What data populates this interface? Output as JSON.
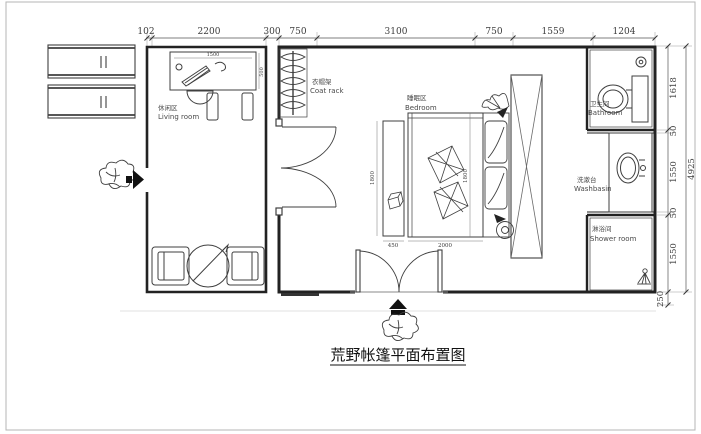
{
  "title": "荒野帐篷平面布置图",
  "labels": {
    "living": {
      "zh": "休闲区",
      "en": "Living room"
    },
    "coat_rack": {
      "zh": "衣帽架",
      "en": "Coat rack"
    },
    "bedroom": {
      "zh": "睡眠区",
      "en": "Bedroom"
    },
    "bathroom": {
      "zh": "卫生间",
      "en": "Bathroom"
    },
    "washbasin": {
      "zh": "洗漱台",
      "en": "Washbasin"
    },
    "shower": {
      "zh": "淋浴间",
      "en": "Shower room"
    }
  },
  "dimensions": {
    "top": [
      "102",
      "2200",
      "300",
      "750",
      "3100",
      "750",
      "1559",
      "1204"
    ],
    "right": [
      "1618",
      "50",
      "1550",
      "50",
      "1550",
      "250"
    ],
    "right_total": "4925",
    "bed_length": "2000",
    "bed_width": "1800",
    "bench_width": "450",
    "bench_height": "1800",
    "desk_width": "1500",
    "desk_depth": "500"
  },
  "colors": {
    "wall": "#222222",
    "furniture_line": "#3f3f3f",
    "dim_line": "#555555",
    "dim_text": "#3c3c3c",
    "background": "#ffffff",
    "frame": "#b5b5b5"
  }
}
